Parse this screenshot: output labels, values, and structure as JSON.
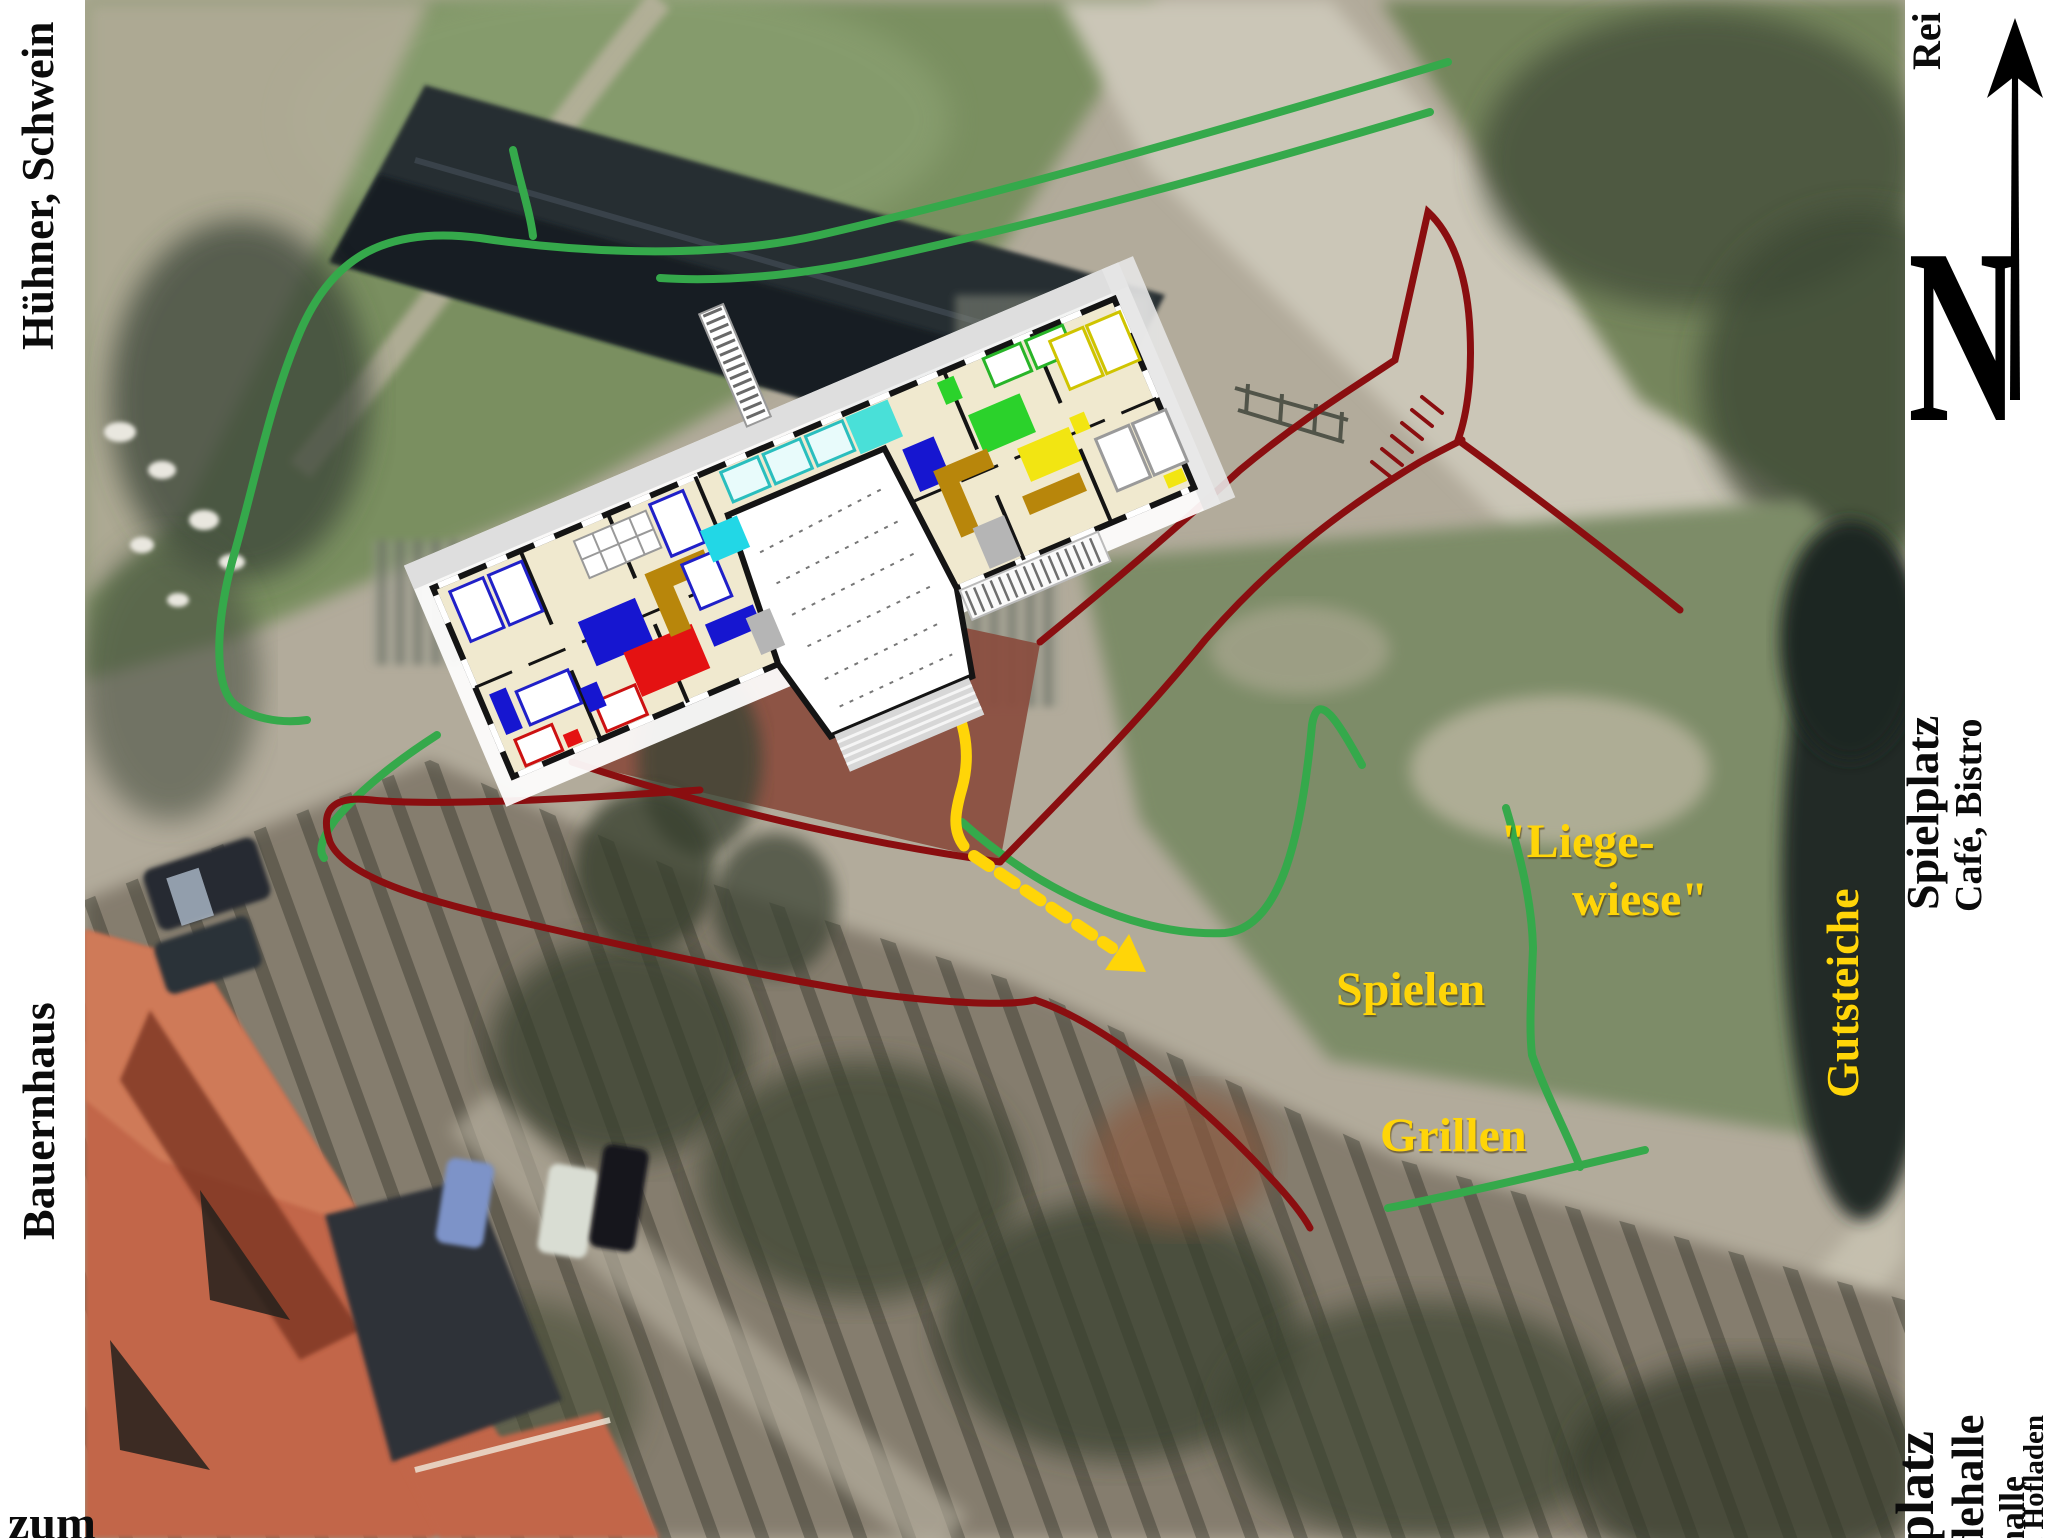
{
  "side_labels": {
    "top_left": "Hühner, Schwein",
    "left": "Bauernhaus",
    "bottom_left": "zum",
    "top_right": "Rei",
    "right_upper": "Spielplatz",
    "right_upper_sub": "Café, Bistro",
    "bottom_right": [
      "platz",
      "dehalle",
      "halle",
      "i, Hofladen"
    ]
  },
  "compass": {
    "letter": "N"
  },
  "map_labels": {
    "pond": "Gutsteiche",
    "meadow_line1": "\"Liege-",
    "meadow_line2": "wiese\"",
    "play": "Spielen",
    "grill": "Grillen"
  },
  "colors": {
    "annotation_yellow": "#ffd508",
    "path_green": "#35a94b",
    "path_red": "#8a0e10",
    "terrace": "#8a4c3e",
    "label_black": "#0b0b0b",
    "strip_white": "#ffffff",
    "plan_beige": "#f0e9cf",
    "plan_wall": "#141414",
    "furn_blue": "#1616d0",
    "furn_red": "#e41212",
    "furn_cyan": "#22d7e6",
    "furn_turquoise": "#49e0d8",
    "furn_green": "#2bd22b",
    "furn_yellow": "#f2e512",
    "furn_gold": "#b8860b"
  }
}
